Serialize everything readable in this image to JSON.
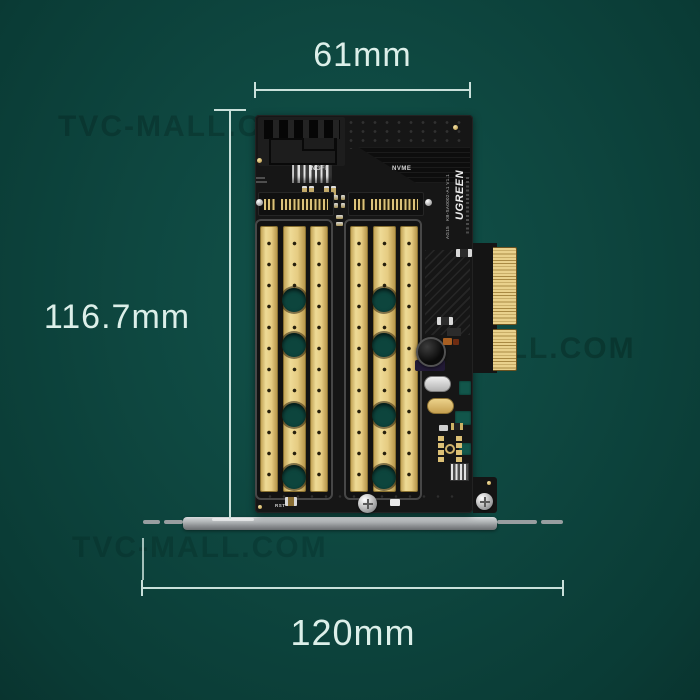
{
  "annotations": {
    "width_top": "61mm",
    "height_left": "116.7mm",
    "width_bottom": "120mm"
  },
  "pcb_text": {
    "slot_left": "NGFF",
    "slot_right": "NVME",
    "brand": "UGREEN",
    "model": "KB-SA0002-A1 V1.1",
    "batch": "AG15",
    "silkscreen_rst": "RST"
  },
  "watermark": {
    "text": "TVC-MALL.COM"
  },
  "colors": {
    "background": "#0e473f",
    "annotation": "#d9ece7",
    "pcb_black": "#161616",
    "gold": "#e3c87e",
    "bracket_silver": "#a7abad",
    "hole_teal": "#0d453d"
  }
}
